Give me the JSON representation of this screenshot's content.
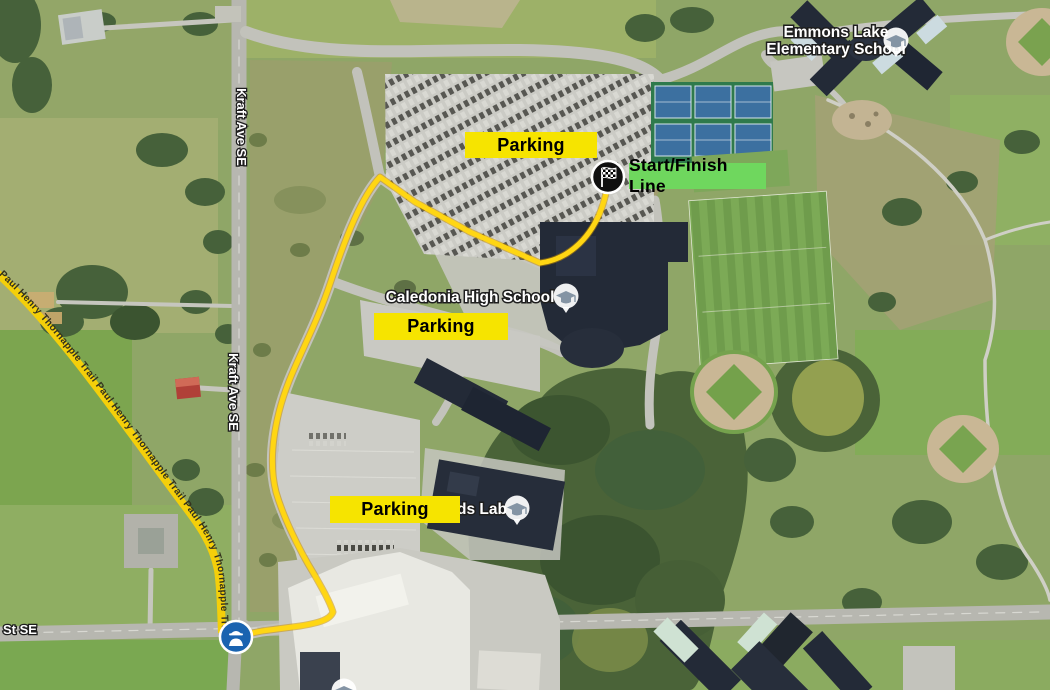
{
  "annotations": {
    "parking_label": "Parking",
    "start_finish_label": "Start/Finish Line"
  },
  "places": {
    "elementary_school_line1": "Emmons Lake",
    "elementary_school_line2": "Elementary School",
    "high_school": "Caledonia High School",
    "lab_label_partial": "ds Lab"
  },
  "roads": {
    "kraft_ave": "Kraft Ave SE",
    "street_partial": "St SE",
    "trail": "Paul Henry Thornapple Trail",
    "trail_repeated": "Paul Henry Thornapple Trail        Paul Henry Thornapple Trail        Paul Henry Thornapple Trail"
  },
  "markers": {
    "start_finish": "checkered-flag-marker",
    "crossing": "police-officer-marker",
    "schools": "graduation-cap-pin"
  },
  "colors": {
    "annotation_yellow": "#f6e400",
    "annotation_green": "#6fd75e",
    "route": "#ffd613",
    "trail": "#f4cf0a",
    "marker_blue": "#1a63b0",
    "pin_glyph_gray": "#8494a4"
  }
}
